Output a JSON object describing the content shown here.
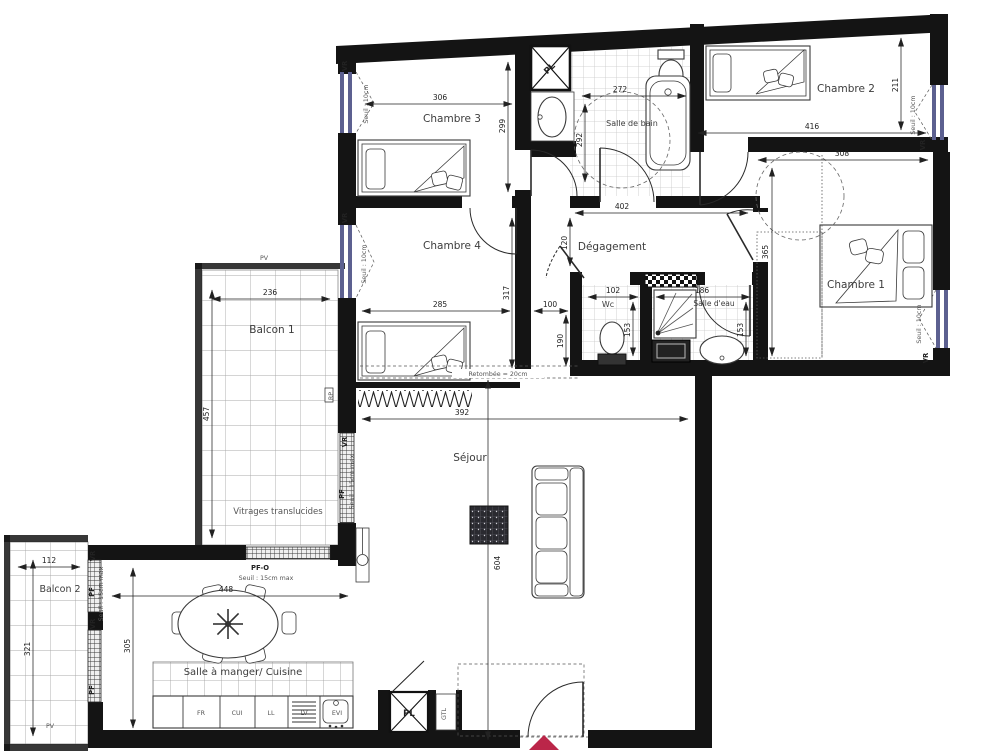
{
  "rooms": {
    "chambre1": "Chambre 1",
    "chambre2": "Chambre 2",
    "chambre3": "Chambre 3",
    "chambre4": "Chambre 4",
    "salle_de_bain": "Salle de bain",
    "degagement": "Dégagement",
    "wc": "Wc",
    "salle_eau": "Salle d'eau",
    "sejour": "Séjour",
    "cuisine": "Salle à manger/ Cuisine",
    "balcon1": "Balcon 1",
    "balcon2": "Balcon 2"
  },
  "dims": {
    "ch3_w": "306",
    "ch3_h": "299",
    "sdb_w": "272",
    "sdb_h": "292",
    "ch2_h": "211",
    "ch2_w": "416",
    "ch1_w": "308",
    "ch1_h": "365",
    "deg_w": "402",
    "deg_h": "120",
    "ch4_w": "285",
    "ch4_h": "317",
    "pass_w": "100",
    "pass_h": "190",
    "wc_w": "102",
    "wc_h": "153",
    "se_w": "186",
    "se_h": "153",
    "balc1_w": "236",
    "balc1_h": "457",
    "sej_w": "392",
    "sej_h": "604",
    "balc2_w": "112",
    "balc2_h": "321",
    "cui_h": "305",
    "cui_w": "448"
  },
  "annotations": {
    "pv": "PV",
    "rp": "RP",
    "vr": "VR",
    "pf": "PF",
    "pfo": "PF-O",
    "pl": "PL",
    "gtl": "GTL",
    "vitrages": "Vitrages translucides",
    "seuil10": "Seuil : 10cm",
    "seuil15": "Seuil : 15cm max",
    "retombee": "Retombée = 20cm"
  },
  "kitchen": {
    "fr": "FR",
    "cui": "CUI",
    "ll": "LL",
    "lv": "LV",
    "evi": "EVI"
  },
  "colors": {
    "wall": "#141414",
    "entrance": "#bb2649",
    "glass": "#5c6090"
  }
}
